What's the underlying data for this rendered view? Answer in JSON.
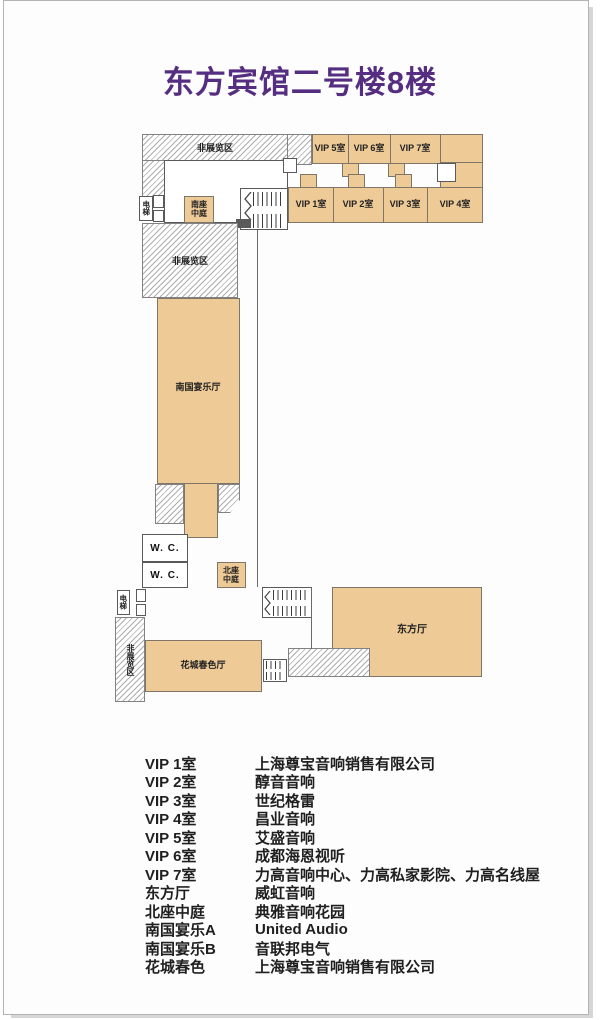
{
  "title": "东方宾馆二号楼8楼",
  "plan": {
    "non_exhibit_area_top": "非展览区",
    "non_exhibit_area_mid": "非展览区",
    "non_exhibit_area_bottom": "非展览区",
    "elevator_top": "电梯",
    "elevator_bottom": "电梯",
    "south_atrium": "南座中庭",
    "north_atrium": "北座中庭",
    "south_banquet_hall": "南国宴乐厅",
    "flower_city_hall": "花城春色厅",
    "oriental_hall": "东方厅",
    "wc_upper": "W. C.",
    "wc_lower": "W. C.",
    "vip_rooms_top": [
      "VIP 5室",
      "VIP 6室",
      "VIP 7室"
    ],
    "vip_rooms_bottom": [
      "VIP 1室",
      "VIP 2室",
      "VIP 3室",
      "VIP 4室"
    ]
  },
  "legend": {
    "rows": [
      {
        "room": "VIP 1室",
        "company": "上海尊宝音响销售有限公司"
      },
      {
        "room": "VIP 2室",
        "company": "醇音音响"
      },
      {
        "room": "VIP 3室",
        "company": "世纪格雷"
      },
      {
        "room": "VIP 4室",
        "company": "昌业音响"
      },
      {
        "room": "VIP 5室",
        "company": "艾盛音响"
      },
      {
        "room": "VIP 6室",
        "company": "成都海恩视听"
      },
      {
        "room": "VIP 7室",
        "company": "力高音响中心、力高私家影院、力高名线屋"
      },
      {
        "room": "东方厅",
        "company": "威虹音响"
      },
      {
        "room": "北座中庭",
        "company": "典雅音响花园"
      },
      {
        "room": "南国宴乐A",
        "company": "United Audio"
      },
      {
        "room": "南国宴乐B",
        "company": "音联邦电气"
      },
      {
        "room": "花城春色",
        "company": "上海尊宝音响销售有限公司"
      }
    ]
  },
  "colors": {
    "title": "#562e81",
    "room_fill": "#eeca96",
    "room_border": "#7e7668",
    "hatch_line": "#adadad",
    "text": "#1f1f1f"
  }
}
